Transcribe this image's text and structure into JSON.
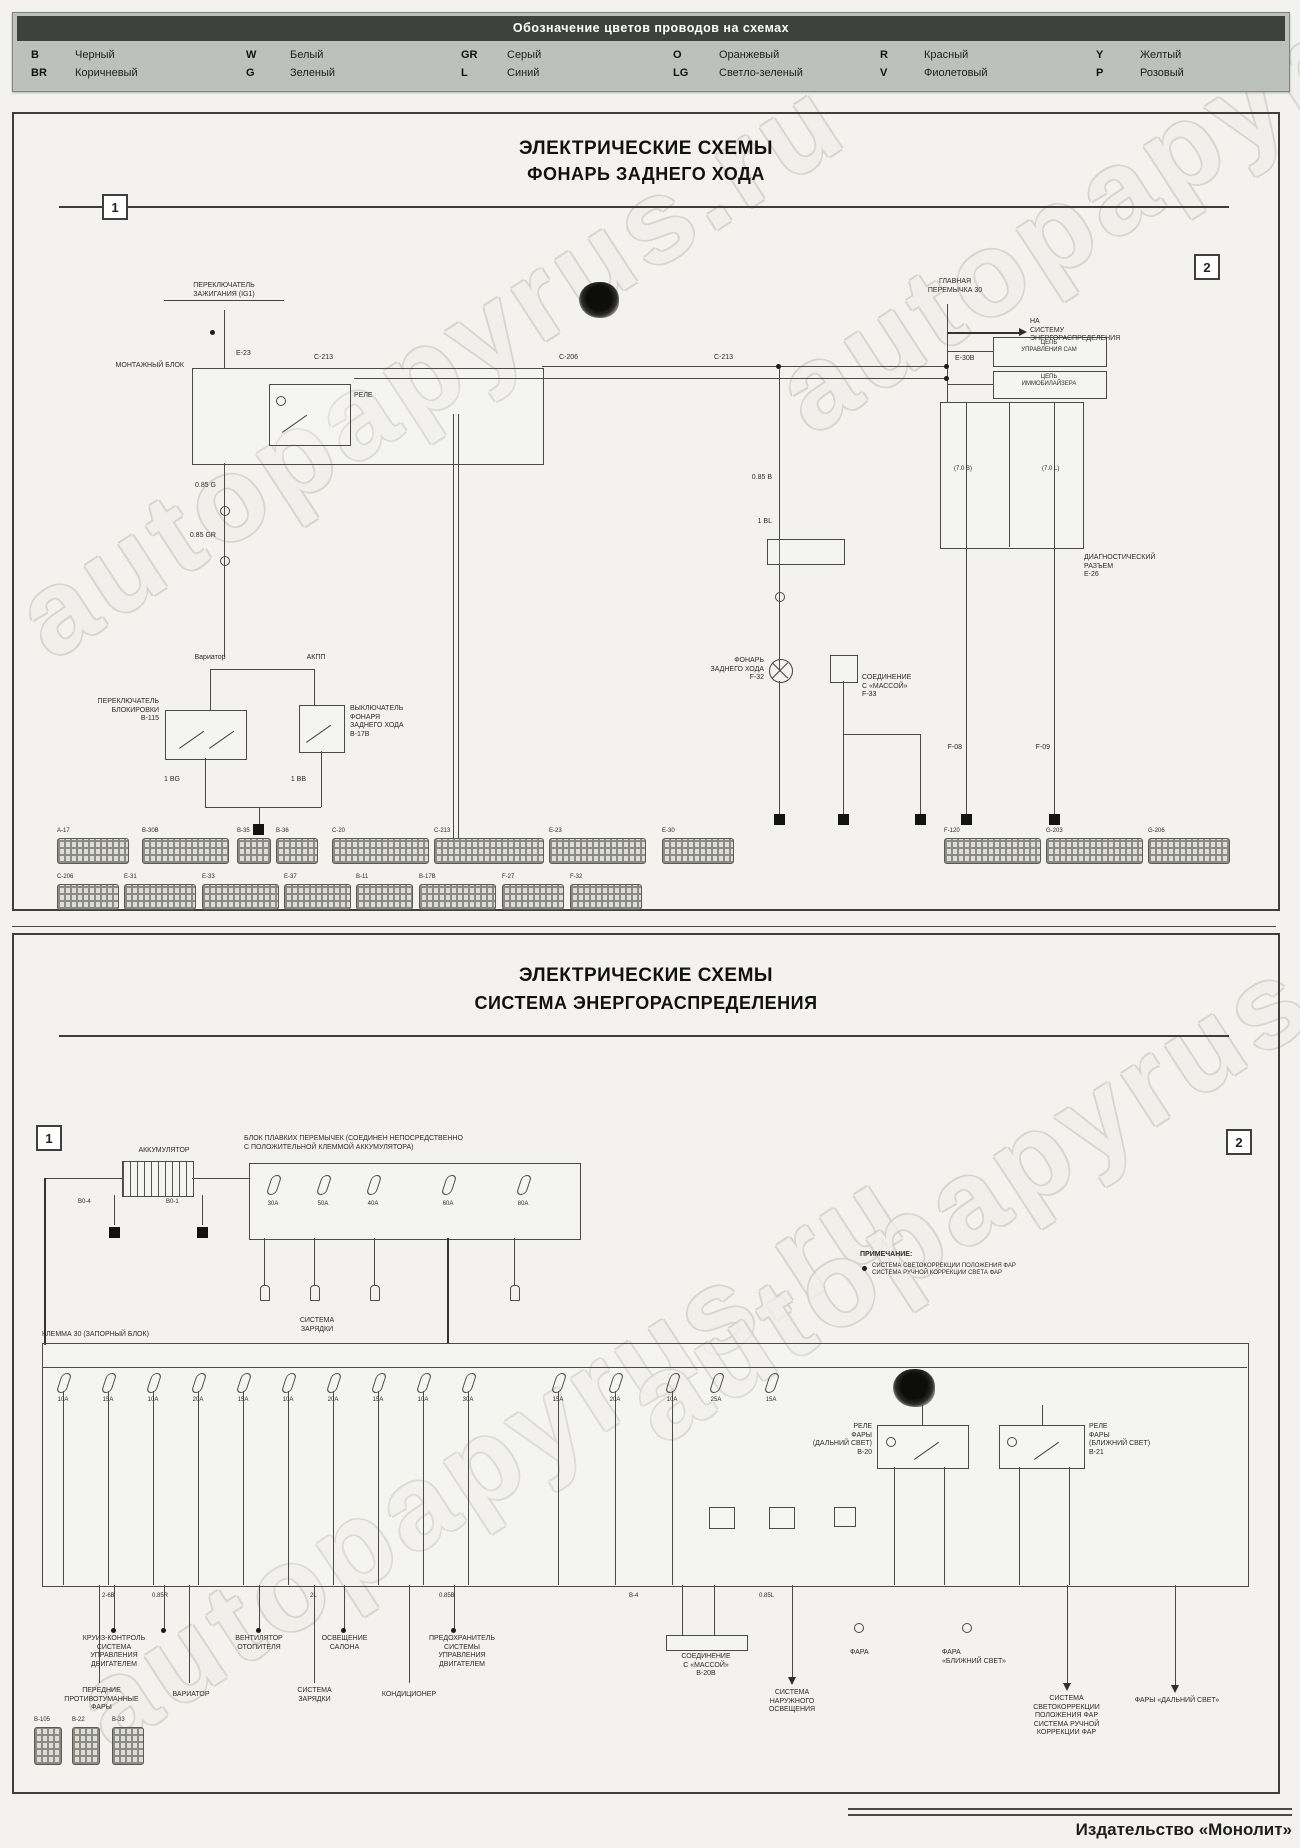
{
  "watermark": "autopapyrus.ru",
  "footer": {
    "publisher": "Издательство «Монолит»"
  },
  "legend": {
    "title": "Обозначение цветов проводов на схемах",
    "entries": [
      {
        "code": "B",
        "name": "Черный"
      },
      {
        "code": "BR",
        "name": "Коричневый"
      },
      {
        "code": "W",
        "name": "Белый"
      },
      {
        "code": "G",
        "name": "Зеленый"
      },
      {
        "code": "GR",
        "name": "Серый"
      },
      {
        "code": "L",
        "name": "Синий"
      },
      {
        "code": "O",
        "name": "Оранжевый"
      },
      {
        "code": "LG",
        "name": "Светло-зеленый"
      },
      {
        "code": "R",
        "name": "Красный"
      },
      {
        "code": "V",
        "name": "Фиолетовый"
      },
      {
        "code": "Y",
        "name": "Желтый"
      },
      {
        "code": "P",
        "name": "Розовый"
      }
    ]
  },
  "panel1": {
    "title_line1": "ЭЛЕКТРИЧЕСКИЕ СХЕМЫ",
    "title_line2": "ФОНАРЬ ЗАДНЕГО ХОДА",
    "marker_left": "1",
    "marker_right": "2",
    "labels": {
      "ignition": "ПЕРЕКЛЮЧАТЕЛЬ\nЗАЖИГАНИЯ (IG1)",
      "mount_block": "МОНТАЖНЫЙ БЛОК",
      "relay": "РЕЛЕ",
      "conn_e23": "E-23",
      "conn_c213": "C-213",
      "conn_c206": "C-206",
      "conn_c213b": "C-213",
      "wire_g": "0.85 G",
      "wire_gr": "0.85 GR",
      "wire_b": "0.85 B",
      "wire_bl": "1 BL",
      "wire_bg": "1 BG",
      "wire_bb": "1 BB",
      "variator": "Вариатор",
      "akpp": "АКПП",
      "switch_lock": "ПЕРЕКЛЮЧАТЕЛЬ\nБЛОКИРОВКИ\nB-115",
      "switch_reverse": "ВЫКЛЮЧАТЕЛЬ\nФОНАРЯ\nЗАДНЕГО ХОДА\nB-17B",
      "reverse_lamp": "ФОНАРЬ\nЗАДНЕГО ХОДА\nF-32",
      "ground_join": "СОЕДИНЕНИЕ\nС «МАССОЙ»\nF-33",
      "main_link": "ГЛАВНАЯ\nПЕРЕМЫЧКА 30",
      "to_distribution": "НА\nСИСТЕМУ\nЭНЕРГОРАСПРЕДЕЛЕНИЯ",
      "circuit_control": "ЦЕПЬ\nУПРАВЛЕНИЯ САМ",
      "circuit_immo": "ЦЕПЬ\nИММОБИЛАЙЗЕРА",
      "diag_connector": "ДИАГНОСТИЧЕСКИЙ\nРАЗЪЕМ\nE-26",
      "conn_e30": "E-30B",
      "wire_70b": "(7.0 B)",
      "wire_70l": "(7.0 L)",
      "gcode1": "F-08",
      "gcode2": "F-09"
    },
    "connectors_row1": [
      "A-17",
      "B-30B",
      "B-35",
      "B-36",
      "C-20",
      "C-213",
      "E-23",
      "E-30",
      "F-120",
      "G-203",
      "G-206"
    ],
    "connectors_row2": [
      "C-206",
      "E-31",
      "E-33",
      "E-37",
      "B-11",
      "B-17B",
      "F-27",
      "F-32"
    ]
  },
  "panel2": {
    "title_line1": "ЭЛЕКТРИЧЕСКИЕ СХЕМЫ",
    "title_line2": "СИСТЕМА ЭНЕРГОРАСПРЕДЕЛЕНИЯ",
    "marker_left": "1",
    "marker_right": "2",
    "labels": {
      "battery": "АККУМУЛЯТОР",
      "bat_code1": "B0-4",
      "bat_code2": "B0-1",
      "fusebox_header": "БЛОК ПЛАВКИХ ПЕРЕМЫЧЕК (СОЕДИНЕН НЕПОСРЕДСТВЕННО\nС ПОЛОЖИТЕЛЬНОЙ КЛЕММОЙ АККУМУЛЯТОРА)",
      "charge_sys": "СИСТЕМА\nЗАРЯДКИ",
      "note_title": "ПРИМЕЧАНИЕ:",
      "note_lines": "СИСТЕМА СВЕТОКОРРЕКЦИИ ПОЛОЖЕНИЯ ФАР\nСИСТЕМА РУЧНОЙ КОРРЕКЦИИ СВЕТА ФАР",
      "terminal30": "КЛЕММА 30 (ЗАПОРНЫЙ БЛОК)",
      "relay_high": "РЕЛЕ\nФАРЫ\n(ДАЛЬНИЙ СВЕТ)\nB-20",
      "relay_low": "РЕЛЕ\nФАРЫ\n(БЛИЖНИЙ СВЕТ)\nB-21",
      "col_cruise": "КРУИЗ-КОНТРОЛЬ\nСИСТЕМА\nУПРАВЛЕНИЯ\nДВИГАТЕЛЕМ",
      "col_heater": "ВЕНТИЛЯТОР\nОТОПИТЕЛЯ",
      "col_cabin": "ОСВЕЩЕНИЕ\nСАЛОНА",
      "col_fuse_engine": "ПРЕДОХРАНИТЕЛЬ\nСИСТЕМЫ\nУПРАВЛЕНИЯ\nДВИГАТЕЛЕМ",
      "fog": "ПЕРЕДНИЕ\nПРОТИВОТУМАННЫЕ\nФАРЫ",
      "variator": "ВАРИАТОР",
      "charge_sys2": "СИСТЕМА\nЗАРЯДКИ",
      "aircon": "КОНДИЦИОНЕР",
      "ground_box": "СОЕДИНЕНИЕ\nС «МАССОЙ»\nB-20B",
      "ext_light": "СИСТЕМА\nНАРУЖНОГО\nОСВЕЩЕНИЯ",
      "headlamp1": "ФАРА",
      "headlamp2": "ФАРА\n«БЛИЖНИЙ СВЕТ»",
      "corr_sys": "СИСТЕМА\nСВЕТОКОРРЕКЦИИ\nПОЛОЖЕНИЯ ФАР\nСИСТЕМА РУЧНОЙ\nКОРРЕКЦИИ ФАР",
      "high_beams": "ФАРЫ «ДАЛЬНИЙ СВЕТ»"
    },
    "fuse_amps": [
      "30A",
      "50A",
      "40A",
      "60A",
      "80A"
    ],
    "big_fuse_amps": [
      "10A",
      "15A",
      "10A",
      "20A",
      "15A",
      "10A",
      "20A",
      "15A",
      "10A",
      "30A",
      "15A",
      "20A",
      "10A",
      "25A",
      "15A"
    ],
    "wire_codes": [
      "2-6B",
      "0.85R",
      "2L",
      "0.85B",
      "B-4",
      "0.85L"
    ],
    "conn_codes": [
      "B-105",
      "B-22",
      "B-33"
    ]
  }
}
